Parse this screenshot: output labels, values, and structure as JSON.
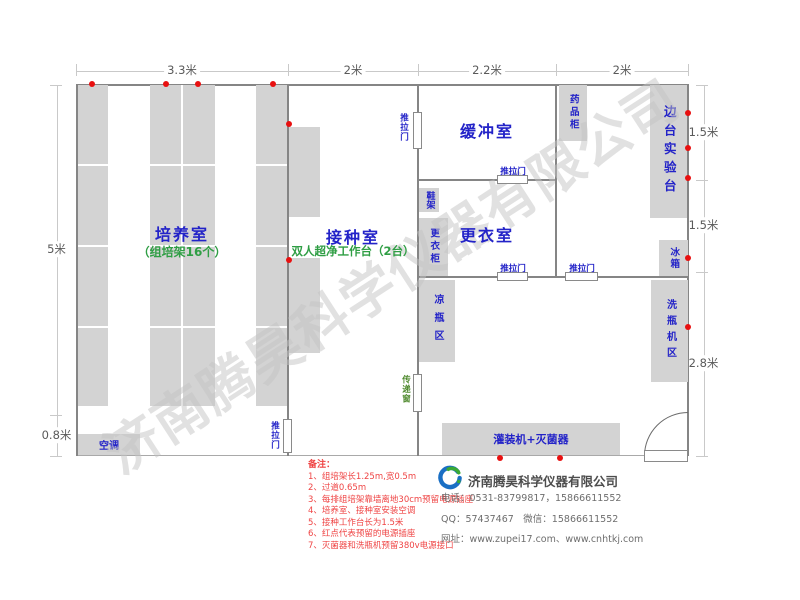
{
  "watermark": "济南腾昊科学仪器有限公司",
  "dimensions": {
    "top": [
      "3.3米",
      "2米",
      "2.2米",
      "2米"
    ],
    "left": [
      "5米",
      "0.8米"
    ],
    "right": [
      "1.5米",
      "1.5米",
      "2.8米"
    ]
  },
  "rooms": {
    "cultivation": {
      "name": "培养室",
      "subtitle": "（组培架16个）"
    },
    "inoculation": {
      "name": "接种室",
      "subtitle": "双人超净工作台（2台）"
    },
    "buffer": {
      "name": "缓冲室"
    },
    "changing": {
      "name": "更衣室"
    }
  },
  "doors": {
    "sliding_door": "推拉门",
    "pass_window": "传递窗"
  },
  "equipment": {
    "air_conditioner": "空调",
    "medicine_cabinet": "药品柜",
    "side_bench": "边台实验台",
    "fridge": "冰箱",
    "bottle_washer_area": "洗瓶机区",
    "bottle_cooling_area": "凉瓶区",
    "wardrobe": "更衣柜",
    "shoe_rack": "鞋架",
    "filling_machine": "灌装机+灭菌器"
  },
  "notes": {
    "title": "备注：",
    "items": [
      "1、组培架长1.25m,宽0.5m",
      "2、过道0.65m",
      "3、每排组培架靠墙离地30cm预留电源插座",
      "4、培养室、接种室安装空调",
      "5、接种工作台长为1.5米",
      "6、红点代表预留的电源插座",
      "7、灭菌器和洗瓶机预留380v电源接口"
    ]
  },
  "company": {
    "name": "济南腾昊科学仪器有限公司",
    "phone": "电话：0531-83799817，15866611552",
    "qq": "QQ：57437467　微信：15866611552",
    "website": "网址：www.zupei17.com、www.cnhtkj.com"
  },
  "colors": {
    "room_label": "#2323c8",
    "subtitle_green": "#2f9e44",
    "pass_window_green": "#4f8a2e",
    "equipment_fill": "#d3d3d3",
    "wall": "#858585",
    "red_dot": "#e81010",
    "note_red": "#ef4444",
    "watermark": "#c4c4c4",
    "logo_blue": "#1a6fc4",
    "logo_green": "#3aa935"
  }
}
